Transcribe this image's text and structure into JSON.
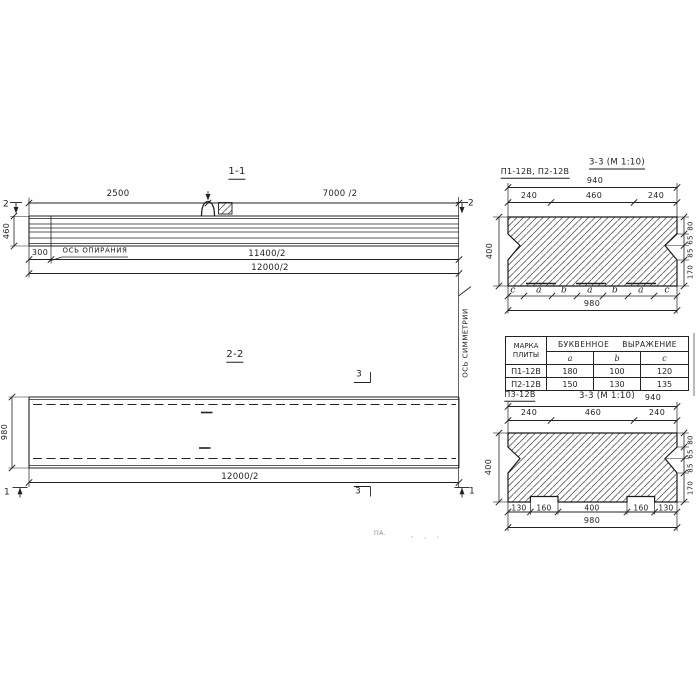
{
  "drawing": {
    "view_1_1": {
      "title": "1-1",
      "section_marker": "2",
      "dims": {
        "d2500": "2500",
        "d7000": "7000 /2",
        "d460": "460",
        "d300": "300",
        "d11400": "11400/2",
        "d12000": "12000/2"
      },
      "support_axis_label": "ОСЬ ОПИРАНИЯ"
    },
    "view_2_2": {
      "title": "2-2",
      "marker_1": "1",
      "marker_3": "3",
      "dims": {
        "d980": "980",
        "d12000": "12000/2"
      },
      "symmetry_axis_label": "ОСЬ СИММЕТРИИ"
    },
    "section_p12": {
      "label": "П1-12В, П2-12В",
      "title": "3-3 (М 1:10)",
      "dims": {
        "d940": "940",
        "d240": "240",
        "d460": "460",
        "d400": "400",
        "d980": "980"
      },
      "right_dims": [
        "80",
        "65",
        "85",
        "170"
      ],
      "letters": [
        "c",
        "a",
        "b",
        "a",
        "b",
        "a",
        "c"
      ]
    },
    "table": {
      "col_mark": "МАРКА ПЛИТЫ",
      "col_expr": "БУКВЕННОЕ ВЫРАЖЕНИЕ",
      "cols": [
        "a",
        "b",
        "c"
      ],
      "rows": [
        {
          "mark": "П1-12В",
          "a": "180",
          "b": "100",
          "c": "120"
        },
        {
          "mark": "П2-12В",
          "a": "150",
          "b": "130",
          "c": "135"
        }
      ]
    },
    "section_p3": {
      "label": "П3-12В",
      "title": "3-3 (М 1:10)",
      "dims": {
        "d940": "940",
        "d240": "240",
        "d460": "460",
        "d400": "400",
        "d980": "980"
      },
      "right_dims": [
        "80",
        "65",
        "85",
        "170"
      ],
      "bottom_dims": [
        "130",
        "160",
        "400",
        "160",
        "130"
      ]
    },
    "artifact": "ПА."
  },
  "colors": {
    "ink": "#1f1f1f",
    "paper": "#ffffff"
  }
}
